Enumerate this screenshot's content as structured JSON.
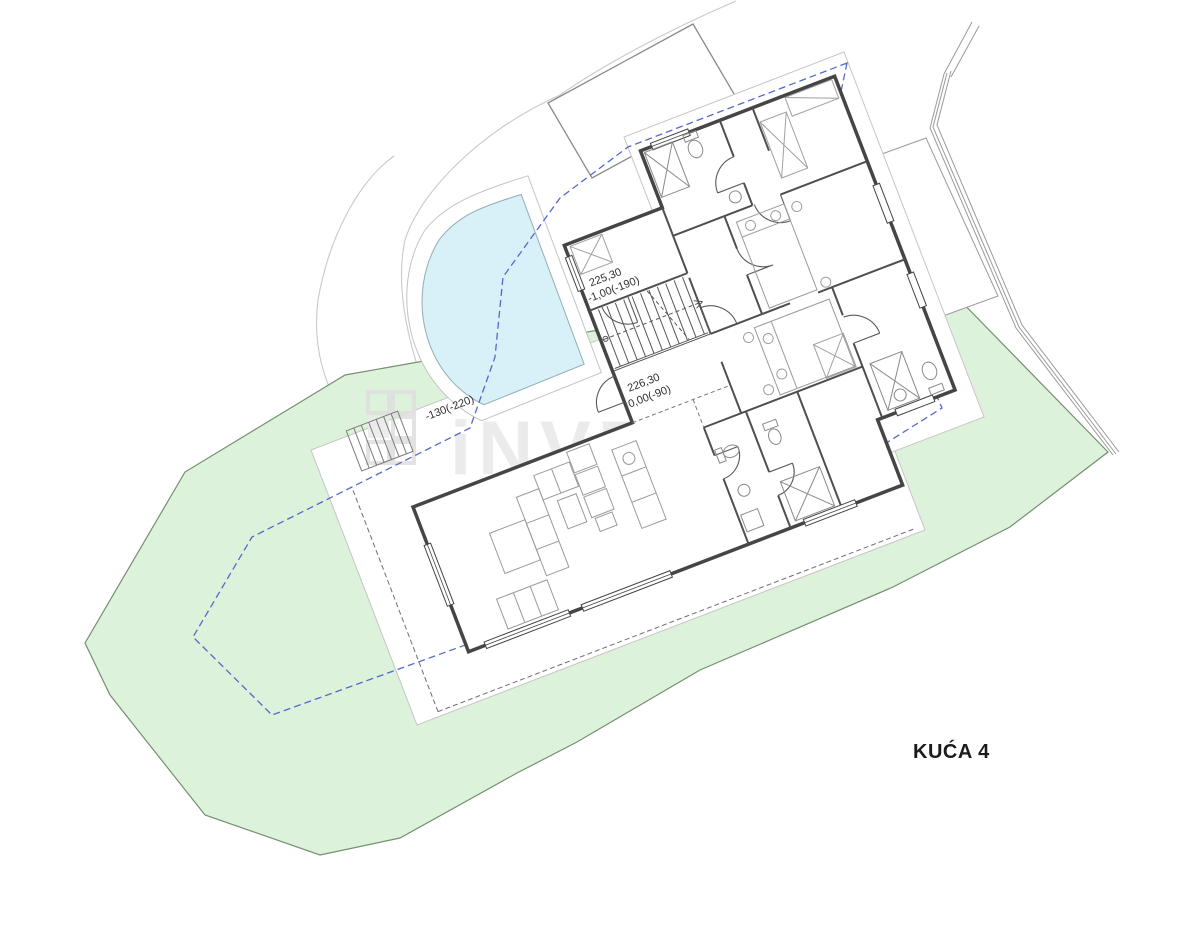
{
  "plan": {
    "title": "KUĆA 4",
    "watermark": {
      "name": "iNVESTA"
    },
    "levels": {
      "stair_upper": {
        "absolute": "225,30",
        "relative": "-1,00(-190)"
      },
      "entry": {
        "absolute": "226,30",
        "relative": "0,00(-90)"
      },
      "pool_terrace": {
        "relative": "-130(-220)"
      }
    },
    "colors": {
      "parcel_green": "#ddf2da",
      "parcel_border": "#74906f",
      "boundary_blue": "#5569cd",
      "pool_fill": "#d8f1f8",
      "pool_border": "#93adb4",
      "wall_dark": "#454545",
      "terrain_gray": "#c9c9c9"
    }
  }
}
